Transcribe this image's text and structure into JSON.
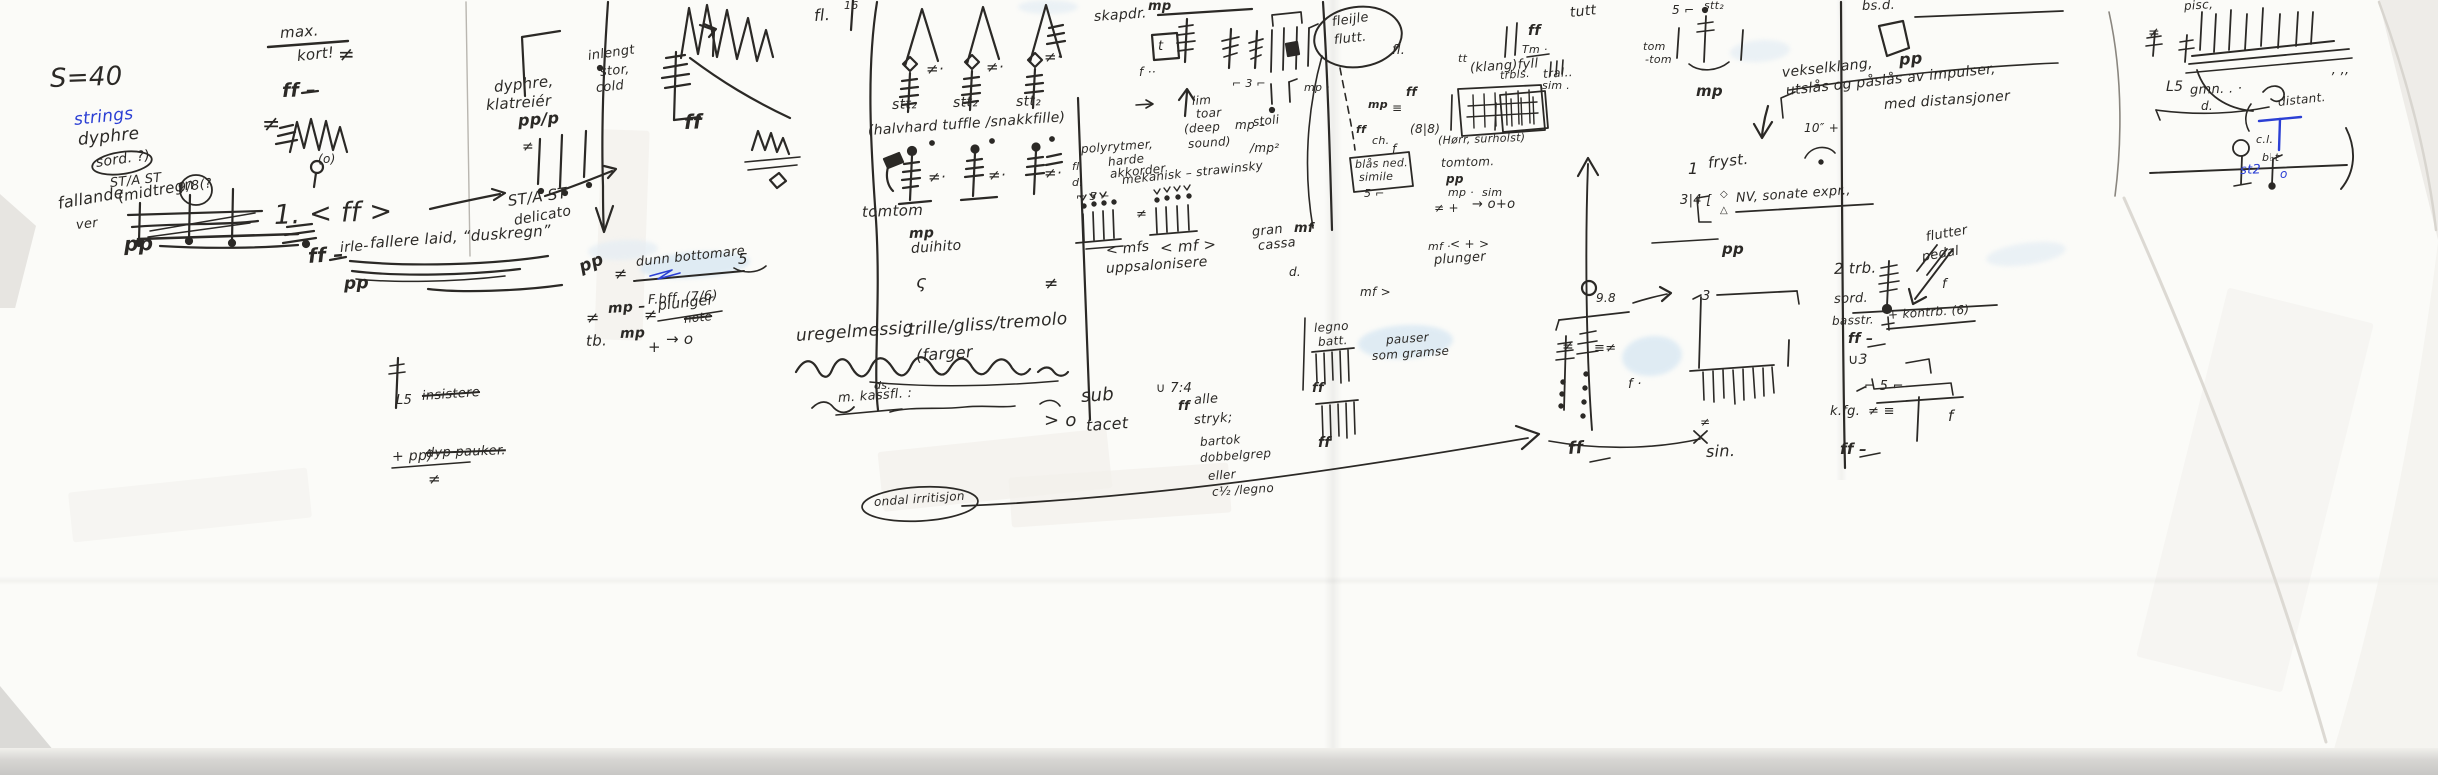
{
  "colors": {
    "ink": "#2b2926",
    "blue_ink": "#2b3fd4",
    "highlighter": "#d9e8f3",
    "paper": "#fbfbf8",
    "scanner_edge": "#c8c7c5"
  },
  "g": {
    "left": [
      "S=40",
      "strings",
      "dyphre",
      "sord. ?)",
      "ST/A ST",
      "fallande",
      "ver",
      "(midtregn",
      "9/8(?",
      "pp",
      "max.",
      "kort!",
      "ff –",
      "(o)",
      "1. < ff >",
      "ff –",
      "≠",
      "≠"
    ],
    "col2": [
      "irle-",
      "fallere laid, “duskregn”",
      "pp",
      "dyphre,",
      "klatreiér",
      "pp/p",
      "inlengt",
      "stor,",
      "cold",
      "ST/A ST",
      "delicato",
      "ff",
      "pp",
      "≠",
      "dunn bottomare",
      "F.bff. (7/6)",
      "≠",
      "mp –",
      "≠",
      "plunger",
      "note",
      "tb.",
      "mp",
      "+",
      "→ o",
      "5",
      "L5",
      "insistere",
      "+ pp)",
      "dyp pauker.",
      "≠",
      "≠"
    ],
    "col3": [
      "fl.",
      "16",
      "stt₂",
      "stt₂",
      "stt₂",
      "≠·",
      "≠·",
      "≠·",
      "(halvhard tuffle /snakkfille)",
      "tomtom",
      "≠·",
      "≠·",
      "≠·",
      "mp",
      "duihito",
      "ς",
      "≠",
      "uregelmessig",
      "trille/gliss/tremolo",
      "(farger",
      "ds.",
      "m. kassfl. :",
      "sub",
      "> o",
      "tacet",
      "ondal irritisjon"
    ],
    "mid": [
      "skapdr.",
      "mp",
      "f ··",
      "lim",
      "toar",
      "(deep",
      "sound)",
      "mp –",
      "stoli",
      "/mp²",
      "polyrytmer,",
      "harde",
      "akkorder",
      "mekanisk – strawinsky",
      "fl.",
      "d.",
      "⌐ 5 ⌐",
      "< mfs",
      "< mf >",
      "uppsalonisere",
      "gran",
      "mf",
      "cassa",
      "d.",
      "legno",
      "batt.",
      "ff",
      "ff",
      "∪ 7:4",
      "ff",
      "alle",
      "stryk;",
      "bartok",
      "dobbelgrep",
      "eller",
      "c½ /legno",
      "pauser",
      "som gramse",
      "mf ·",
      "< + >",
      "plunger",
      "fleijle",
      "flutt.",
      "fl.",
      "ff",
      "mp",
      "≡",
      "ff",
      "ch.",
      "f",
      "(8|8)",
      "(Hørr, sürholst)",
      "tomtom.",
      "pp",
      "mp ·",
      "sim",
      "≠ +",
      "→ o+o",
      "tt",
      "(klang)fyll",
      "tral..",
      "blås ned.",
      "simile",
      "5 ⌐",
      "t",
      "mf >",
      "⌐ 3 ⌐",
      "mp ·",
      "≠"
    ],
    "right": [
      "tutt",
      "ff",
      "Tm ·",
      "trbls.",
      "sim .",
      "tom",
      "-tom",
      "5 ⌐",
      "stt₂",
      "mp",
      "vekselklang,",
      "utslås og påslås av impulser,",
      "med distansjoner",
      "10″ +",
      "1",
      "fryst.",
      "3|4 [",
      "◇",
      "△",
      "NV, sonate expr.,",
      "bs.d.",
      "pp"
    ],
    "c98": [
      "pp",
      "9.8",
      "f ·",
      "ff",
      "3",
      "≠",
      "sin.",
      "≠",
      "≡≠"
    ],
    "far": [
      "2 trb.",
      "pedal",
      "flutter",
      "sord.",
      "basstr.",
      "+ kontrb. (6)",
      "ff –",
      "∪3",
      "⌐ 5 ⌐",
      "k.fg.",
      "≠ ≡",
      "f",
      "ff –",
      "f"
    ],
    "sketch": [
      "pisc,",
      "≠",
      "L5",
      "gmn. . ·",
      "d.",
      "c.l.",
      "distant.",
      "b♭t",
      "st2",
      "o",
      "’ ’’"
    ]
  }
}
